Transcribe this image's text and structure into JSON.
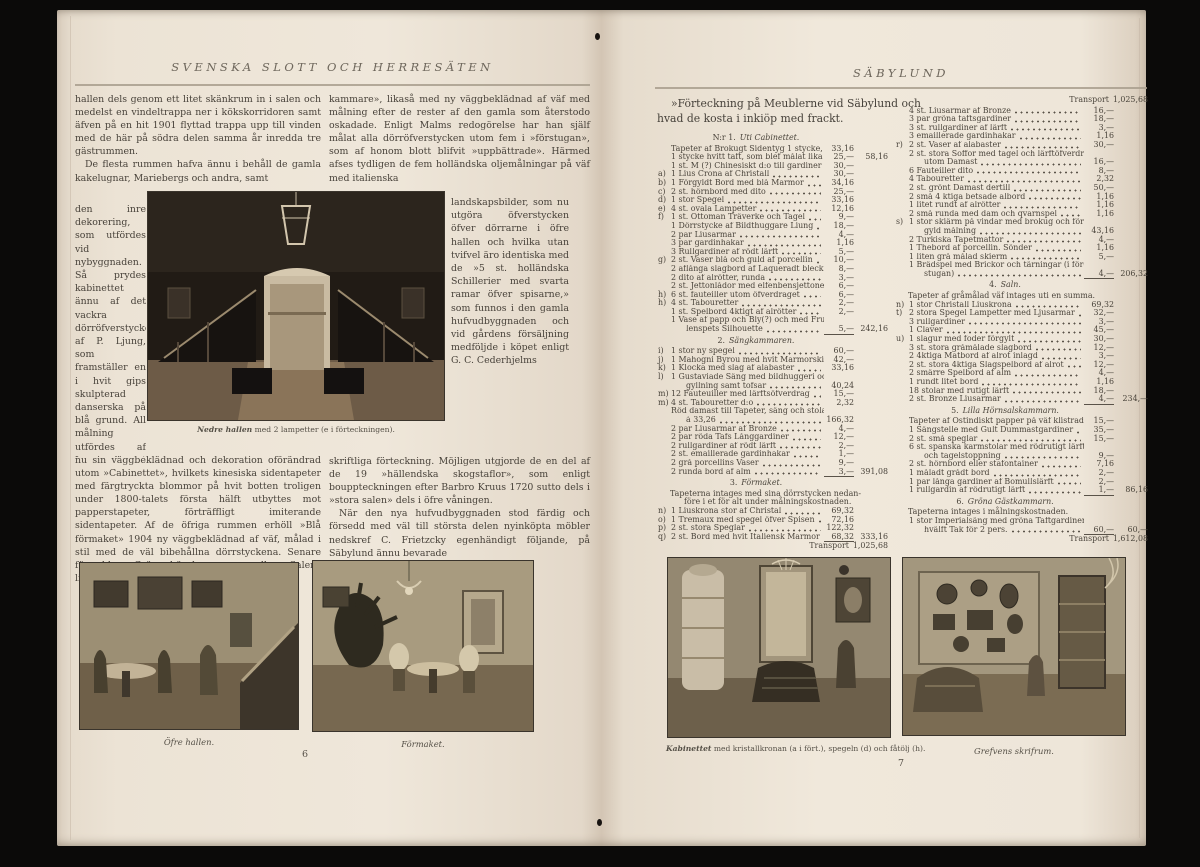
{
  "left_page": {
    "header": "SVENSKA SLOTT OCH HERRESÄTEN",
    "page_number": "6",
    "col1_top_p1": "hallen dels genom ett litet skänkrum in i salen och medelst en vindeltrappa ner i kökskorridoren samt äfven på en hit 1901 flyttad trappa upp till vinden med de här på södra delen samma år inredda tre gästrummen.",
    "col1_top_p2": "De flesta rummen hafva ännu i behåll de gamla kakelugnar, Mariebergs och andra, samt",
    "col1_strip": "den inre dekorering, som utfördes vid nybyggnaden. Så prydes kabinettet ännu af det vackra dörröfverstycke af P. Ljung, som framställer en i hvit gips skulpterad danserska på blå grund. All målning utfördes af Lars August Malm enligt räkning, som här meddelas. De sex å denna först uppförda rummen hafva än-",
    "col1_bottom": "nu sin väggbeklädnad och dekoration oförändrad utom »Cabinettet», hvilkets kinesiska sidentapeter med färgtryckta blommor på hvit botten troligen under 1800-talets första hälft utbyttes mot papperstapeter, förträffligt imiterande sidentapeter. Af de öfriga rummen erhöll »Blå förmaket» 1904 ny väggbeklädnad af väf, målad i stil med de väl bibehållna dörrstyckena. Senare förseddes »Gröna hörnkammaren» eller »Salens lilla hörn-",
    "col2_top": "kammare», likaså med ny väggbeklädnad af väf med målning efter de rester af den gamla som återstodo oskadade. Enligt Malms redogörelse har han själf målat alla dörröfverstycken utom fem i »förstugan», som af honom blott blifvit »uppbättrade». Härmed afses tydligen de fem holländska oljemålningar på väf med italienska",
    "col2_strip": "landskapsbilder, som nu utgöra öfverstycken öfver dörrarne i öfre hallen och hvilka utan tvifvel äro identiska med de »5 st. holländska Schillerier med svarta ramar öfver spisarne,» som funnos i den gamla hufvudbyggnaden och vid gårdens försäljning medföljde i köpet enligt G. C. Cederhjelms",
    "col2_bottom_p1": "skriftliga förteckning. Möjligen utgjorde de en del af de 19 »hällendska skogstaflor», som enligt bouppteckningen efter Barbro Kruus 1720 sutto dels i »stora salen» dels i öfre våningen.",
    "col2_bottom_p2": "När den nya hufvudbyggnaden stod färdig och försedd med väl till största delen nyinköpta möbler nedskref C. Frietzcky egenhändigt följande, på Säbylund ännu bevarade",
    "main_caption_lead": "Nedre hallen",
    "main_caption_rest": " med 2 lampetter (e i förteckningen).",
    "photo_upper_hall_caption": "Öfre hallen.",
    "photo_parlour_caption": "Förmaket."
  },
  "right_page": {
    "header": "SÄBYLUND",
    "page_number": "7",
    "title_line1": "»Förteckning på Meublerne vid Säbylund och",
    "title_line2": "hvad de kosta i inkiöp med frackt.",
    "photo_cabinet_caption_lead": "Kabinettet",
    "photo_cabinet_caption_rest": " med kristallkronan (a i fört.), spegeln (d) och fåtölj (h).",
    "photo_study_caption": "Grefvens skrifrum.",
    "inventory": {
      "columns": [
        {
          "blocks": [
            {
              "k": "sec",
              "n": "N:r 1.",
              "t": "Uti Cabinettet."
            },
            {
              "k": "r",
              "t": "Tapeter af Brokugt Sidentyg 1 stycke, inköpt till",
              "p": "33,16"
            },
            {
              "k": "r",
              "t": "1 stycke hvitt taft, som blef målat lika",
              "p": "25,—",
              "s": "58,16"
            },
            {
              "k": "r",
              "t": "1 st. M (?) Chinesiskt d:o till gardiner och stolar",
              "p": "30,—"
            },
            {
              "k": "r",
              "l": "a)",
              "t": "1 Lius Crona af Christall",
              "p": "30,—"
            },
            {
              "k": "r",
              "l": "b)",
              "t": "1 Förgyldt Bord med blå Marmor",
              "p": "34,16"
            },
            {
              "k": "r",
              "l": "c)",
              "t": "2 st. hörnbord med dito",
              "p": "25,—"
            },
            {
              "k": "r",
              "l": "d)",
              "t": "1 stor Spegel",
              "p": "33,16"
            },
            {
              "k": "r",
              "l": "e)",
              "t": "4 st. ovala Lampetter",
              "p": "12,16"
            },
            {
              "k": "r",
              "l": "f)",
              "t": "1 st. Ottoman Träverke och Tagel",
              "p": "9,—"
            },
            {
              "k": "r",
              "t": "1 Dörrstycke af Bildthuggare Liung",
              "p": "18,—"
            },
            {
              "k": "r",
              "t": "2 par Liusarmar",
              "p": "4,—"
            },
            {
              "k": "r",
              "t": "3 par gardinhakar",
              "p": "1,16"
            },
            {
              "k": "r",
              "t": "3 Rullgardiner af rödt lärft",
              "p": "5,—"
            },
            {
              "k": "r",
              "l": "g)",
              "t": "2 st. Vaser blå och guld af porcellin",
              "p": "10,—"
            },
            {
              "k": "r",
              "t": "2 aflånga slagbord af Laqueradt bleck",
              "p": "8,—"
            },
            {
              "k": "r",
              "t": "2 dito af alrötter, runda",
              "p": "3,—"
            },
            {
              "k": "r",
              "t": "2 st. Jettonlådor med elfenbensjettoner",
              "p": "6,—"
            },
            {
              "k": "r",
              "l": "h)",
              "t": "6 st. fauteiller utom öfverdraget",
              "p": "6,—"
            },
            {
              "k": "r",
              "l": "h)",
              "t": "4 st. Tabouretter",
              "p": "2,—"
            },
            {
              "k": "r",
              "t": "1 st. Spelbord 4ktigt af alrötter",
              "p": "2,—"
            },
            {
              "k": "r",
              "t": "1 Vase af papp och Bly(?) och med Fru Gyl-"
            },
            {
              "k": "r",
              "c": 1,
              "t": "lenspets Silhouette",
              "p": "5,—",
              "u": 1,
              "s": "242,16"
            },
            {
              "k": "sec",
              "n": "2.",
              "t": "Sängkammaren."
            },
            {
              "k": "r",
              "l": "i)",
              "t": "1 stor ny spegel",
              "p": "60,—"
            },
            {
              "k": "r",
              "l": "j)",
              "t": "1 Mahogni Byrou med hvit Marmorskifva",
              "p": "42,—"
            },
            {
              "k": "r",
              "l": "k)",
              "t": "1 Klocka med slag af alabaster",
              "p": "33,16"
            },
            {
              "k": "r",
              "l": "l)",
              "t": "1 Gustaviade Säng med bildhuggeri och för-"
            },
            {
              "k": "r",
              "c": 1,
              "t": "gyllning samt tofsar",
              "p": "40,24"
            },
            {
              "k": "r",
              "l": "m)",
              "t": "12 Fauteuiller med lärftsöfverdrag",
              "p": "15,—"
            },
            {
              "k": "r",
              "l": "m)",
              "t": "4 st. Tabouretter d:o",
              "p": "2,32"
            },
            {
              "k": "r",
              "t": "Röd damast till Tapeter, säng och stolar 5 st."
            },
            {
              "k": "r",
              "c": 1,
              "t": "à 33,26",
              "p": "166,32"
            },
            {
              "k": "r",
              "t": "2 par Liusarmar af Bronze",
              "p": "4,—"
            },
            {
              "k": "r",
              "t": "2 par röda Tafs Långgardiner",
              "p": "12,—"
            },
            {
              "k": "r",
              "t": "2 rullgardiner af rödt lärft",
              "p": "2,—"
            },
            {
              "k": "r",
              "t": "2 st. emaillerade gardinhakar",
              "p": "1,—"
            },
            {
              "k": "r",
              "t": "2 grå porcellins Vaser",
              "p": "9,—"
            },
            {
              "k": "r",
              "t": "2 runda bord af alm",
              "p": "3,—",
              "u": 1,
              "s": "391,08"
            },
            {
              "k": "sec",
              "n": "3.",
              "t": "Förmaket."
            },
            {
              "k": "note",
              "t": "Tapeterna intages med sina dörrstycken nedan-"
            },
            {
              "k": "note",
              "c": 1,
              "t": "före i et för alt under målningskostnaden."
            },
            {
              "k": "r",
              "l": "n)",
              "t": "1 Liuskrona stor af Christal",
              "p": "69,32"
            },
            {
              "k": "r",
              "l": "o)",
              "t": "1 Tremaux med spegel öfver Spisen",
              "p": "72,16"
            },
            {
              "k": "r",
              "l": "p)",
              "t": "2 st. stora Speglar",
              "p": "122,32"
            },
            {
              "k": "r",
              "l": "q)",
              "t": "2 st. Bord med hvit Italiensk Marmor",
              "p": "68,32",
              "u": 1,
              "s": "333,16"
            },
            {
              "k": "tr",
              "t": "Transport",
              "v": "1,025,68"
            }
          ]
        },
        {
          "blocks": [
            {
              "k": "tr",
              "t": "Transport",
              "v": "1,025,68"
            },
            {
              "k": "r",
              "t": "4 st. Liusarmar af Bronze",
              "p": "16,—"
            },
            {
              "k": "r",
              "t": "3 par gröna taftsgardiner",
              "p": "18,—"
            },
            {
              "k": "r",
              "t": "3 st. rullgardiner af lärft",
              "p": "3,—"
            },
            {
              "k": "r",
              "t": "3 emaillerade gardinhakar",
              "p": "1,16"
            },
            {
              "k": "r",
              "l": "r)",
              "t": "2 st. Vaser af alabaster",
              "p": "30,—"
            },
            {
              "k": "r",
              "t": "2 st. stora Soffor med tagel och lärftöfverdrag"
            },
            {
              "k": "r",
              "c": 1,
              "t": "utom Damast",
              "p": "16,—"
            },
            {
              "k": "r",
              "t": "6 Fauteiller dito",
              "p": "8,—"
            },
            {
              "k": "r",
              "t": "4 Tabouretter",
              "p": "2,32"
            },
            {
              "k": "r",
              "t": "2 st. grönt Damast dertill",
              "p": "50,—"
            },
            {
              "k": "r",
              "t": "2 små 4 ktiga betsade albord",
              "p": "1,16"
            },
            {
              "k": "r",
              "t": "1 litet rundt af alrötter",
              "p": "1,16"
            },
            {
              "k": "r",
              "t": "2 små runda med dam och qvarnspel",
              "p": "1,16"
            },
            {
              "k": "r",
              "l": "s)",
              "t": "1 stor skiärm på vindar med brokug och för-"
            },
            {
              "k": "r",
              "c": 1,
              "t": "gyld målning",
              "p": "43,16"
            },
            {
              "k": "r",
              "t": "2 Turkiska Tapetmattor",
              "p": "4,—"
            },
            {
              "k": "r",
              "t": "1 Thebord af porcellin. Sönder",
              "p": "1,16"
            },
            {
              "k": "r",
              "t": "1 liten grå målad skierm",
              "p": "5,—"
            },
            {
              "k": "r",
              "t": "1 Brädspel med Brickor och tärningar (i för-"
            },
            {
              "k": "r",
              "c": 1,
              "t": "stugan)",
              "p": "4,—",
              "u": 1,
              "s": "206,32"
            },
            {
              "k": "sec",
              "n": "4.",
              "t": "Saln."
            },
            {
              "k": "note",
              "t": "Tapeter af gråmålad väf intages uti en summa."
            },
            {
              "k": "r",
              "l": "n)",
              "t": "1 stor Christall Liuskrona",
              "p": "69,32"
            },
            {
              "k": "r",
              "l": "t)",
              "t": "2 stora Spegel Lampetter med Ljusarmar",
              "p": "32,—"
            },
            {
              "k": "r",
              "t": "3 rullgardiner",
              "p": "3,—"
            },
            {
              "k": "r",
              "t": "1 Claver",
              "p": "45,—"
            },
            {
              "k": "r",
              "l": "u)",
              "t": "1 slagur med foder förgylt",
              "p": "30,—"
            },
            {
              "k": "r",
              "t": "3 st. stora gråmålade slagbord",
              "p": "12,—"
            },
            {
              "k": "r",
              "t": "2 4ktiga Matbord af alrot inlagd",
              "p": "3,—"
            },
            {
              "k": "r",
              "t": "2 st. stora 4ktiga Slagspelbord af alrot",
              "p": "12,—"
            },
            {
              "k": "r",
              "t": "2 smärre Spelbord af alm",
              "p": "4,—"
            },
            {
              "k": "r",
              "t": "1 rundt litet bord",
              "p": "1,16"
            },
            {
              "k": "r",
              "t": "18 stolar med rutigt lärft",
              "p": "18,—"
            },
            {
              "k": "r",
              "t": "2 st. Bronze Liusarmar",
              "p": "4,—",
              "u": 1,
              "s": "234,—"
            },
            {
              "k": "sec",
              "n": "5.",
              "t": "Lilla Hörnsalskammarn."
            },
            {
              "k": "r",
              "t": "Tapeter af Ostindiskt papper på väf klistrade",
              "p": "15,—"
            },
            {
              "k": "r",
              "t": "1 Sängstelle med Gult Dummastgardiner",
              "p": "35,—"
            },
            {
              "k": "r",
              "t": "2 st. små speglar",
              "p": "15,—"
            },
            {
              "k": "r",
              "t": "6 st. spanska karmstolar med rödrutigt lärft"
            },
            {
              "k": "r",
              "c": 1,
              "t": "och tagelstoppning",
              "p": "9,—"
            },
            {
              "k": "r",
              "t": "2 st. hörnbord eller stafontainer",
              "p": "7,16"
            },
            {
              "k": "r",
              "t": "1 måladt grådt bord",
              "p": "2,—"
            },
            {
              "k": "r",
              "t": "1 par långa gardiner af Bomullslärft",
              "p": "2,—"
            },
            {
              "k": "r",
              "t": "1 rullgardin af rödrutigt lärft",
              "p": "1,—",
              "u": 1,
              "s": "86,16"
            },
            {
              "k": "sec",
              "n": "6.",
              "t": "Gröna Gästkammarn."
            },
            {
              "k": "note",
              "t": "Tapeterna intages i målningskostnaden."
            },
            {
              "k": "r",
              "t": "1 stor Imperialsäng med gröna Taftgardiner och"
            },
            {
              "k": "r",
              "c": 1,
              "t": "hvälft Tak för 2 pers.",
              "p": "60,—",
              "u": 1,
              "s": "60,—"
            },
            {
              "k": "tr",
              "t": "Transport",
              "v": "1,612,08"
            }
          ]
        }
      ]
    }
  }
}
